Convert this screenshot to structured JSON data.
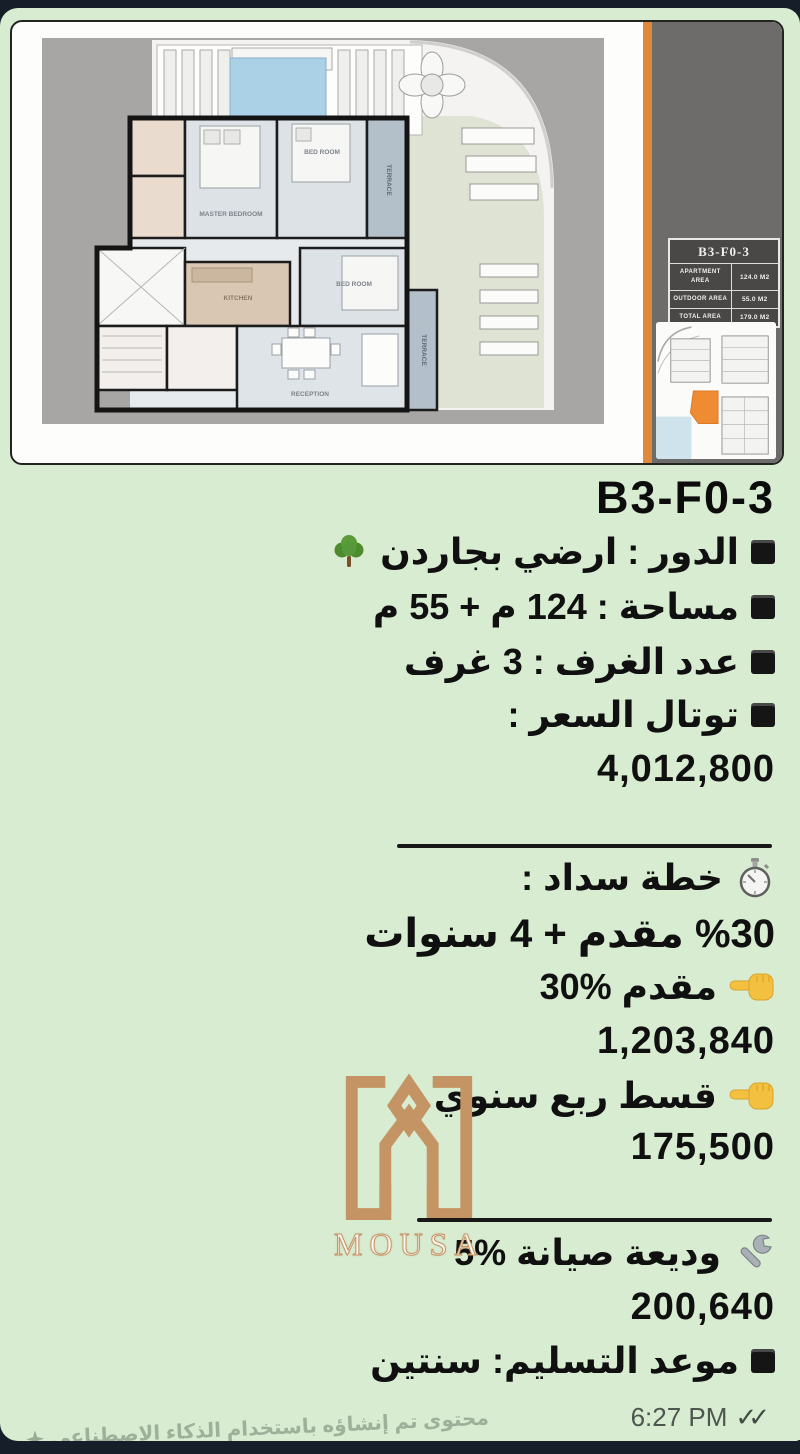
{
  "colors": {
    "bubble_green": "#d8ecd1",
    "backdrop_navy": "#161f29",
    "accent_orange": "#e0893a",
    "panel_gray": "#6e6c6a",
    "plan_gray": "#a7a6a4",
    "brand_gold": "#c49465"
  },
  "plan_card": {
    "unit_table": {
      "title": "B3-F0-3",
      "rows": [
        {
          "label": "APARTMENT AREA",
          "value": "124.0 M2"
        },
        {
          "label": "OUTDOOR AREA",
          "value": "55.0 M2"
        },
        {
          "label": "TOTAL AREA",
          "value": "179.0 M2"
        }
      ]
    },
    "room_labels": {
      "master_bedroom": "MASTER BEDROOM",
      "bedroom_top": "BED ROOM",
      "bedroom_mid": "BED ROOM",
      "kitchen": "KITCHEN",
      "reception": "RECEPTION",
      "terrace_top": "TERRACE",
      "terrace_bottom": "TERRACE"
    }
  },
  "listing": {
    "unit_code": "B3-F0-3",
    "floor_line": "الدور : ارضي بجاردن",
    "area_line": "مساحة : 124 م + 55 م",
    "rooms_line": "عدد الغرف : 3 غرف",
    "total_price_label": "توتال السعر :",
    "total_price_value": "4,012,800",
    "payment_heading": "خطة سداد :",
    "payment_terms": "%30 مقدم + 4 سنوات",
    "downpayment_line": "مقدم %30",
    "downpayment_value": "1,203,840",
    "installment_line": "قسط ربع سنوي",
    "installment_value": "175,500",
    "maintenance_line": "وديعة صيانة %5",
    "maintenance_value": "200,640",
    "delivery_line": "موعد التسليم: سنتين"
  },
  "brand": {
    "name": "MOUSA"
  },
  "message": {
    "time": "6:27 PM",
    "ticks": "✓✓",
    "ai_note": "محتوى تم إنشاؤه باستخدام الذكاء الاصطناعي"
  }
}
